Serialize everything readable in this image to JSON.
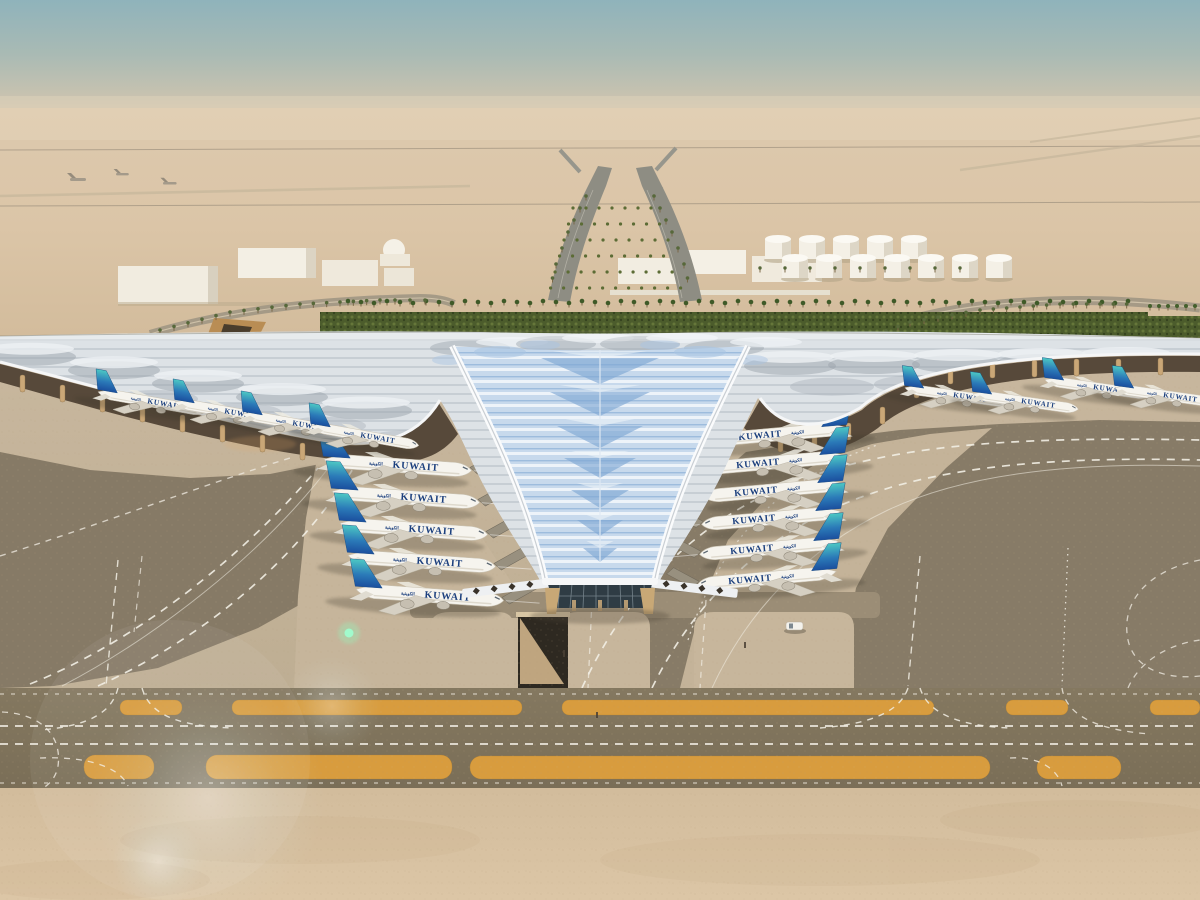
{
  "meta": {
    "title": "Aerial architectural rendering of a new Kuwait International Airport terminal",
    "description": "Daytime bird's-eye rendering of a swooping trefoil-roofed airport terminal in the desert. Kuwait Airways jets are parked along both concourse wings and nose-in to the central glazed V. Curved dark taxiways with dashed white markings wrap the aprons, a dual taxiway band with orange shoulders crosses the foreground, and support buildings, fuel tanks, palm-lined approach roads and power lines sit on the hazy horizon.",
    "setting": "desert airport",
    "time_of_day": "day"
  },
  "palette": {
    "sky_top": "#8fb3bb",
    "sky_horizon": "#d9c8ae",
    "desert": "#dbc5a7",
    "sand_foreground": "#d9c3a3",
    "apron_concrete": "#c4b39a",
    "taxiway_asphalt": "#867a66",
    "taxiway_band": "#80745d",
    "shoulder_orange": "#d89c3e",
    "marking_white": "#f3efe7",
    "roof_silver": "#dfe3e7",
    "roof_shadow_gray": "#9aa3ab",
    "roof_glass_blue": "#c7d9ec",
    "glass_chevron_blue": "#7fa8d4",
    "landscape_green": "#4c5c2c",
    "column_tan": "#caa777",
    "tail_teal": "#4cc8c4",
    "tail_blue": "#1b4f9e",
    "fuselage_white": "#f6f4ee",
    "label_blue": "#1b3f7d"
  },
  "terminal": {
    "roof_style": "swooping trefoil canopy with ribbed billowing roof",
    "central_glazing": "blue chevron-patterned skylight tapering to a glazed apex",
    "support_columns": "tan tapering pylons under the eaves",
    "underground_ramp": true
  },
  "aircraft": {
    "airline_label": "KUWAIT",
    "arabic_label": "الكويتية",
    "total_count": 19,
    "livery": {
      "fuselage": "#f6f4ee",
      "tail_top": "#4cc8c4",
      "tail_bottom": "#1b4f9e",
      "title_color": "#1b3f7d"
    },
    "groups": [
      {
        "name": "left-stand-row",
        "dir": "r",
        "scale": 1,
        "rot": 4,
        "label": true,
        "bridge": true,
        "layer": "under",
        "tails": [
          [
            320,
            460
          ],
          [
            328,
            492
          ],
          [
            336,
            524
          ],
          [
            344,
            556
          ],
          [
            352,
            590
          ]
        ]
      },
      {
        "name": "right-stand-row",
        "dir": "l",
        "scale": 0.94,
        "rot": -5,
        "label": true,
        "bridge": true,
        "layer": "under",
        "tails": [
          [
            850,
            428
          ],
          [
            848,
            456
          ],
          [
            846,
            484
          ],
          [
            844,
            512
          ],
          [
            842,
            542
          ],
          [
            840,
            572
          ]
        ]
      },
      {
        "name": "left-wing-row",
        "dir": "r",
        "scale": 0.74,
        "rot": 10,
        "label": true,
        "bridge": false,
        "layer": "over",
        "tails": [
          [
            95,
            392
          ],
          [
            172,
            402
          ],
          [
            240,
            414
          ],
          [
            308,
            426
          ]
        ]
      },
      {
        "name": "right-wing-row",
        "dir": "r",
        "scale": 0.72,
        "rot": 8,
        "label": true,
        "bridge": false,
        "layer": "over",
        "tails": [
          [
            902,
            388
          ],
          [
            970,
            394
          ],
          [
            1042,
            380
          ],
          [
            1112,
            388
          ]
        ]
      }
    ]
  },
  "airfield": {
    "marking_style": "dashed white taxiway centerlines and edge lines",
    "shoulder_strips": "orange painted shoulders on the foreground dual taxiway",
    "service_vehicle": true,
    "underground_ramp": true
  },
  "background": {
    "power_lines": 2,
    "approach_road": "Y-shaped divided highway lined with palms",
    "left_buildings": 4,
    "right_buildings": 3,
    "dome": true,
    "fuel_tanks": 12,
    "landscape_strip": "dense green hedging with a palm row behind the terminal",
    "distant_aircraft": 4
  },
  "effects": {
    "lens_flare": true,
    "green_flare_dot": true,
    "heat_haze": true
  }
}
